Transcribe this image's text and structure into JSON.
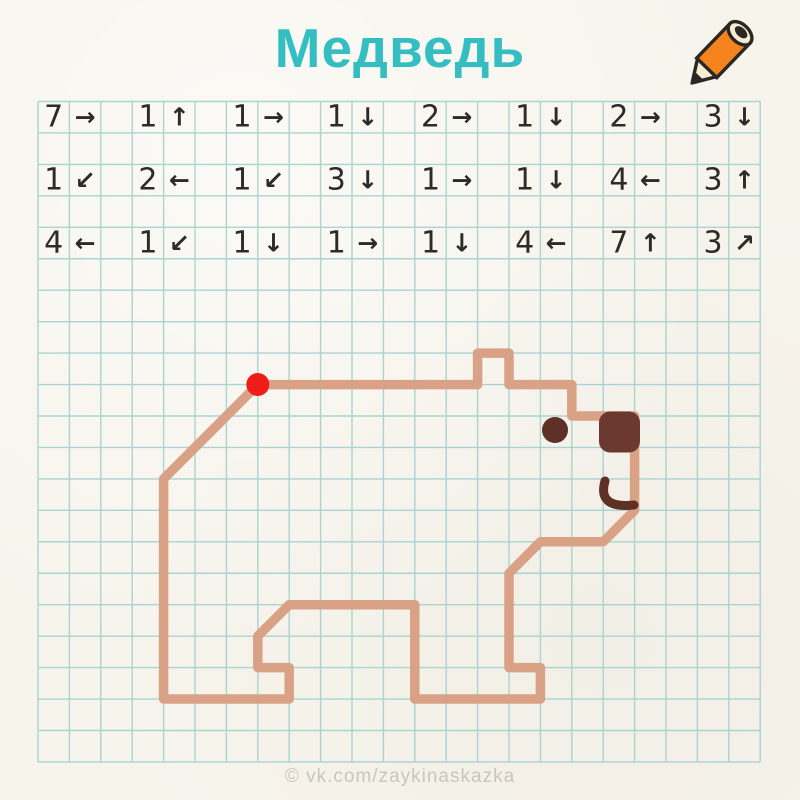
{
  "title": "Медведь",
  "watermark": "© vk.com/zaykinaskazka",
  "colors": {
    "paper": "#f7f4ec",
    "grid_line": "#a9d4d2",
    "title": "#35bec2",
    "ink": "#2d2b28",
    "bear_line": "#d9a287",
    "dark_brown": "#5f3026",
    "nose_brown": "#6b392f",
    "red_dot": "#ee1d18",
    "watermark": "#cac6be",
    "pencil_body": "#f5831e",
    "pencil_cream": "#f6ecd4",
    "pencil_outline": "#2b2722"
  },
  "grid": {
    "cols": 23,
    "rows": 21,
    "origin_x": 38,
    "origin_y": 101.5,
    "cell_w": 31.4,
    "cell_h": 31.45,
    "line_width": 1.4
  },
  "instructions": {
    "grid_rows": [
      0,
      2,
      4
    ],
    "pair_col_stride": 3,
    "rows": [
      [
        {
          "count": 7,
          "arrow": "→"
        },
        {
          "count": 1,
          "arrow": "↑"
        },
        {
          "count": 1,
          "arrow": "→"
        },
        {
          "count": 1,
          "arrow": "↓"
        },
        {
          "count": 2,
          "arrow": "→"
        },
        {
          "count": 1,
          "arrow": "↓"
        },
        {
          "count": 2,
          "arrow": "→"
        },
        {
          "count": 3,
          "arrow": "↓"
        }
      ],
      [
        {
          "count": 1,
          "arrow": "↙"
        },
        {
          "count": 2,
          "arrow": "←"
        },
        {
          "count": 1,
          "arrow": "↙"
        },
        {
          "count": 3,
          "arrow": "↓"
        },
        {
          "count": 1,
          "arrow": "→"
        },
        {
          "count": 1,
          "arrow": "↓"
        },
        {
          "count": 4,
          "arrow": "←"
        },
        {
          "count": 3,
          "arrow": "↑"
        }
      ],
      [
        {
          "count": 4,
          "arrow": "←"
        },
        {
          "count": 1,
          "arrow": "↙"
        },
        {
          "count": 1,
          "arrow": "↓"
        },
        {
          "count": 1,
          "arrow": "→"
        },
        {
          "count": 1,
          "arrow": "↓"
        },
        {
          "count": 4,
          "arrow": "←"
        },
        {
          "count": 7,
          "arrow": "↑"
        },
        {
          "count": 3,
          "arrow": "↗"
        }
      ]
    ]
  },
  "bear": {
    "start_col": 7,
    "start_row": 9,
    "stroke_width": 9.5,
    "start_dot": {
      "r": 11.5
    },
    "nose": {
      "x": 599,
      "y": 411.5,
      "w": 41,
      "h": 41,
      "rx": 11
    },
    "eye": {
      "cx": 555,
      "cy": 430,
      "r": 13
    },
    "mouth": {
      "d": "M 605 481 Q 597 509 634 505",
      "stroke_width": 9
    }
  }
}
